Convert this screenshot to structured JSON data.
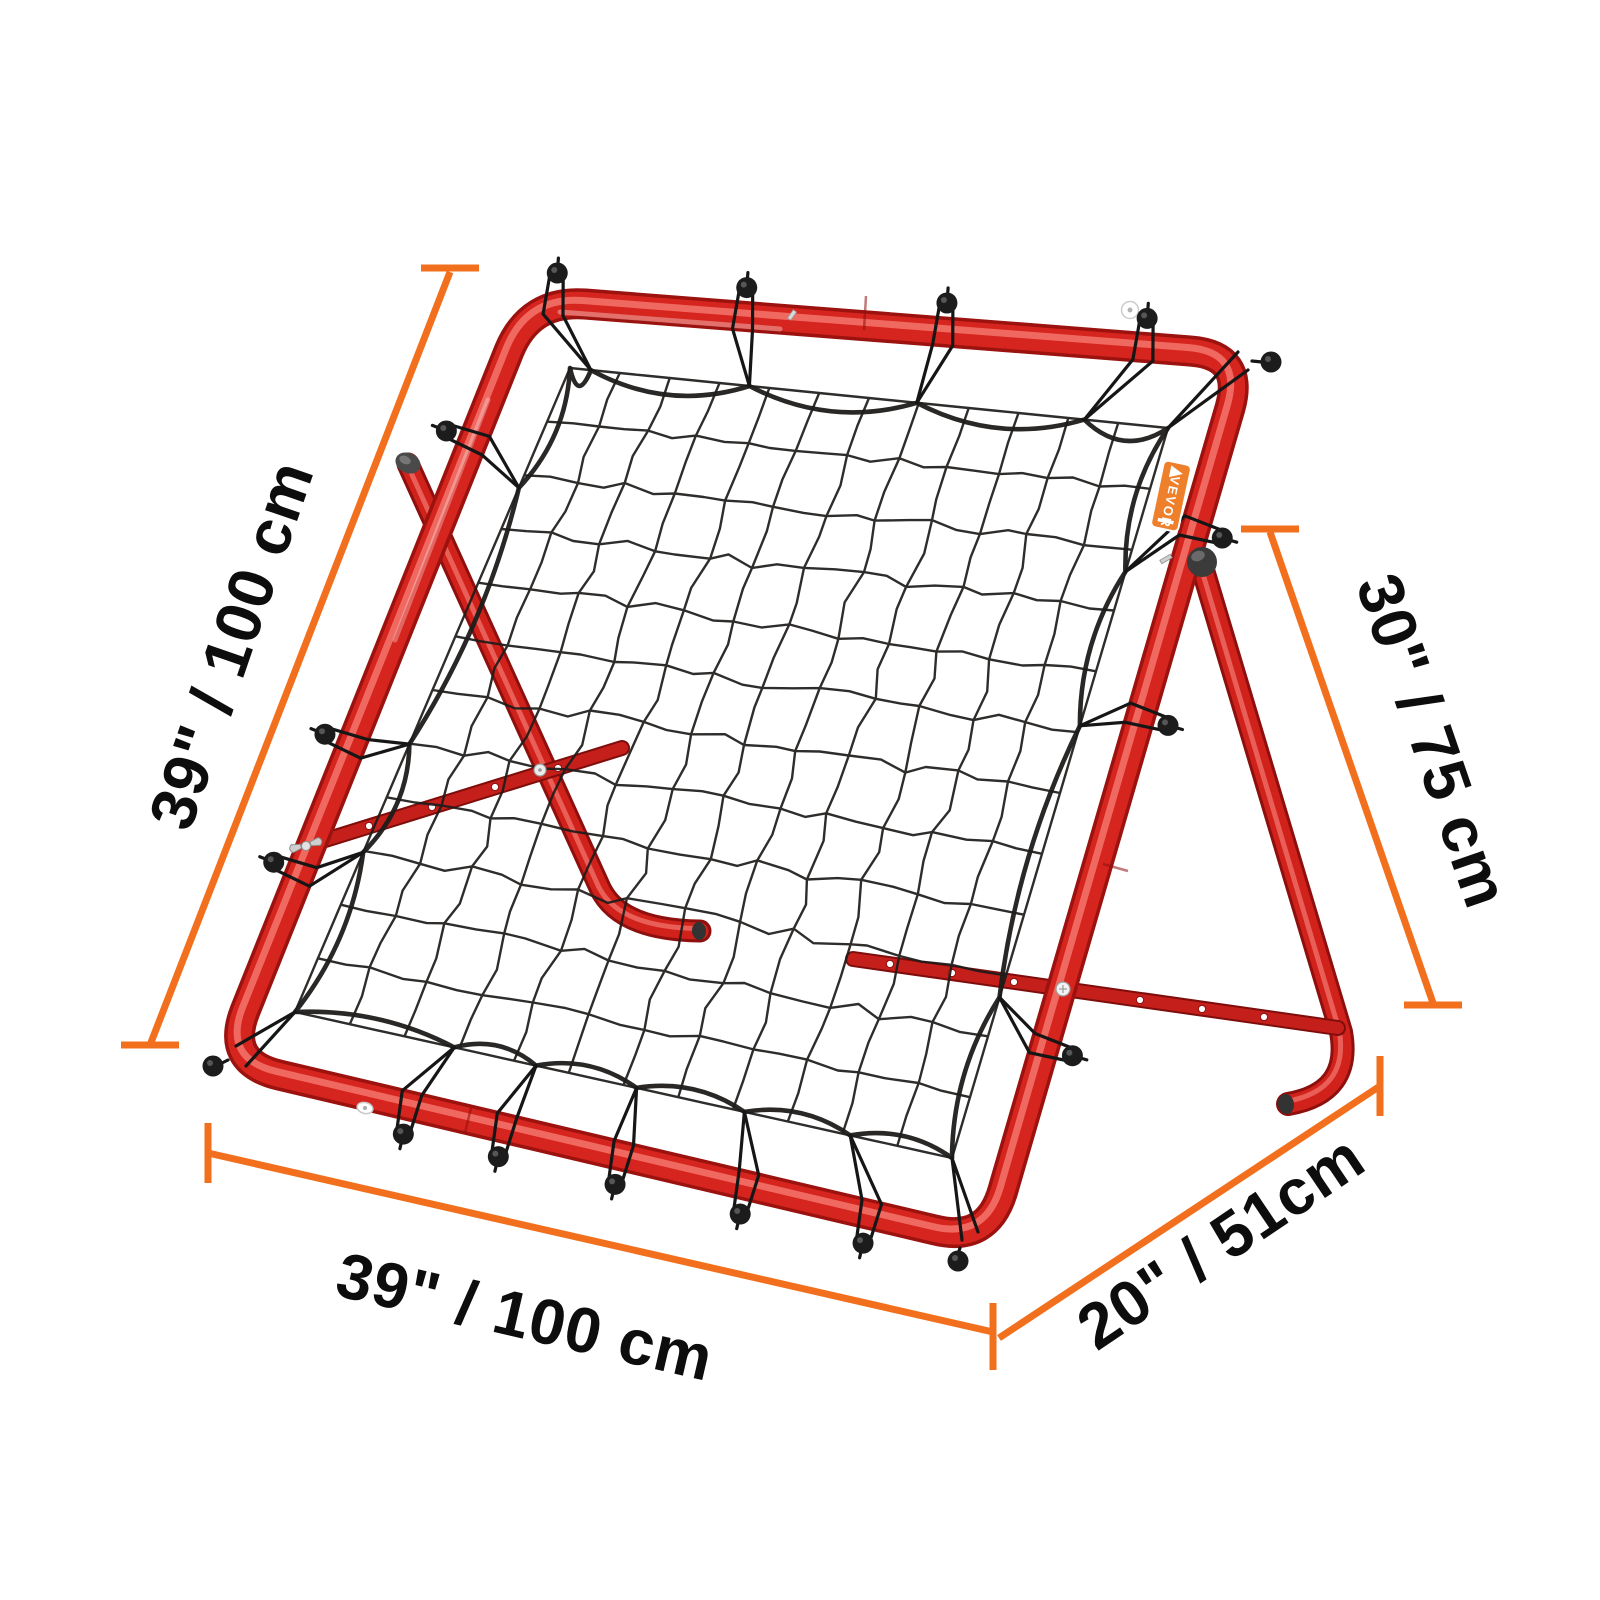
{
  "colors": {
    "background": "#ffffff",
    "accent_orange": "#f2701d",
    "frame_red": "#d6241e",
    "frame_red_dark": "#9b120f",
    "frame_red_highlight": "#f4756c",
    "net_black": "#1e1c1a",
    "label_black": "#0d0d0d",
    "tag_orange": "#ee7f2b"
  },
  "brand_tag": {
    "text": "VEVOR"
  },
  "dimension_labels": {
    "left": "39\" / 100 cm",
    "right": "30\" / 75 cm",
    "bottom": "39\" / 100 cm",
    "depth": "20\" / 51cm"
  }
}
